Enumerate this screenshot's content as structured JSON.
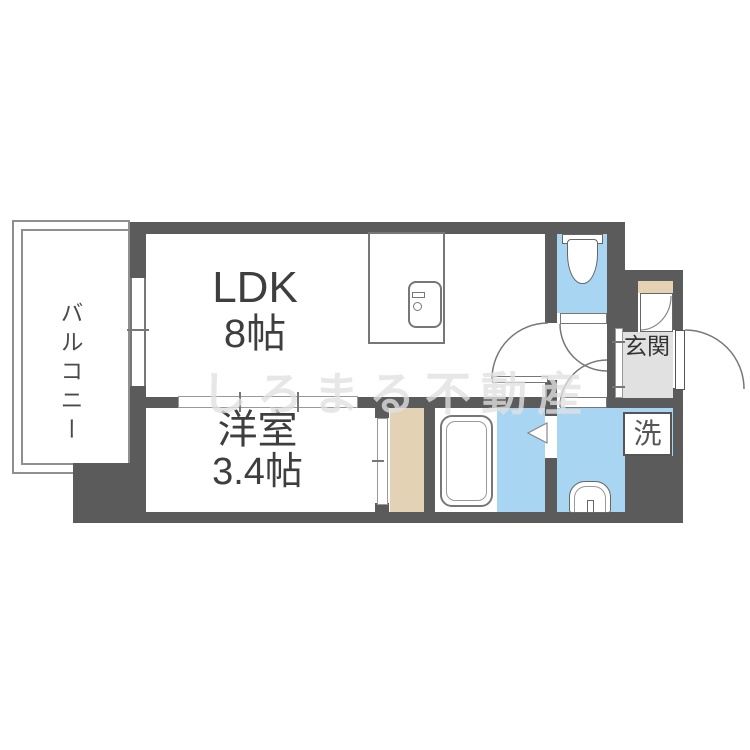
{
  "plan": {
    "type": "apartment-floorplan",
    "labels": {
      "balcony": "バルコニー",
      "ldk": "LDK",
      "ldk_size": "8帖",
      "western_room": "洋室",
      "western_room_size": "3.4帖",
      "entrance": "玄関",
      "laundry": "洗",
      "watermark": "しろまる不動産"
    },
    "colors": {
      "wall": "#5b5b5b",
      "water_area_blue": "#a8d5f1",
      "storage_tan": "#e4d2b5",
      "entrance_floor_gray": "#e1e1e1",
      "fixture_outline": "#777777",
      "text": "#3e3e3e",
      "watermark": "#e0e0e0"
    }
  }
}
